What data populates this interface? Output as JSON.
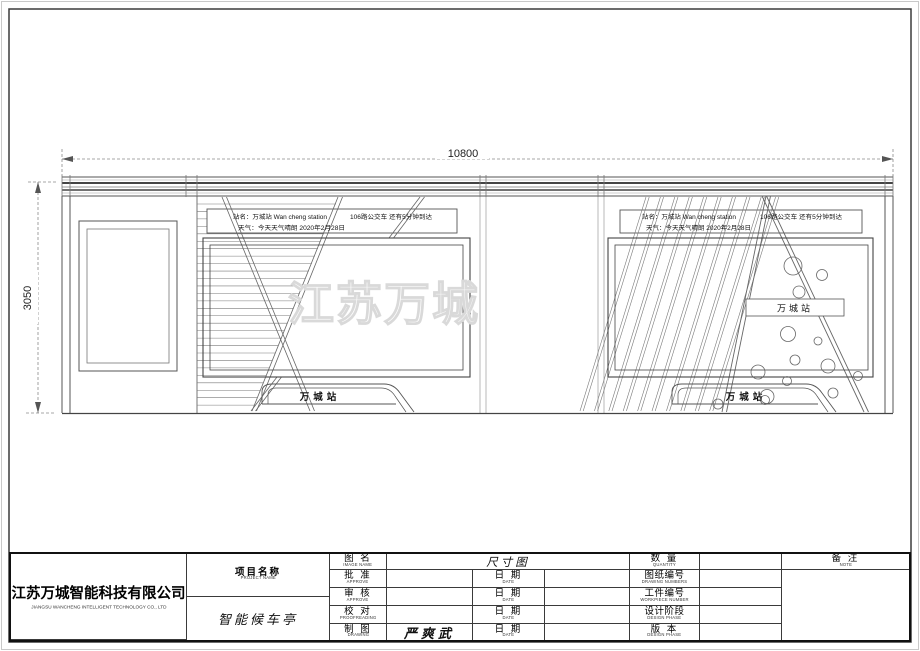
{
  "drawing": {
    "dim_width": "10800",
    "dim_height": "3050",
    "watermark": "江苏万城",
    "shelter": {
      "station_line1": "站名：万城站  Wan cheng station",
      "station_line2": "天气：今天天气晴朗  2020年2月28日",
      "bus_info": "106路公交车  还有5分钟到达",
      "station_sign": "万城站"
    }
  },
  "title_block": {
    "company": {
      "cn": "江苏万城智能科技有限公司",
      "en": "JIANGSU WANCHENG INTELLIGENT TECHNOLOGY CO., LTD"
    },
    "project": {
      "label_cn": "项目名称",
      "label_en": "PROJECT  NAME",
      "value": "智能候车亭"
    },
    "drawing_name": {
      "label_cn": "图  名",
      "label_en": "IMAGE  NAME",
      "value": "尺寸图"
    },
    "mid_rows": [
      {
        "label_cn": "批  准",
        "label_en": "APPROVE",
        "value": "",
        "date_cn": "日  期",
        "date_en": "DATE",
        "date_value": ""
      },
      {
        "label_cn": "审  核",
        "label_en": "APPROVE",
        "value": "",
        "date_cn": "日  期",
        "date_en": "DATE",
        "date_value": ""
      },
      {
        "label_cn": "校  对",
        "label_en": "PROOFREADING",
        "value": "",
        "date_cn": "日  期",
        "date_en": "DATE",
        "date_value": ""
      },
      {
        "label_cn": "制  图",
        "label_en": "DRAWING",
        "value": "严爽武",
        "date_cn": "日  期",
        "date_en": "DATE",
        "date_value": ""
      }
    ],
    "right_rows": [
      {
        "label_cn": "数  量",
        "label_en": "QUANTITY",
        "value": ""
      },
      {
        "label_cn": "图纸编号",
        "label_en": "DRAWING NUMBERS",
        "value": ""
      },
      {
        "label_cn": "工件编号",
        "label_en": "WORKPIECE NUMBER",
        "value": ""
      },
      {
        "label_cn": "设计阶段",
        "label_en": "DESIGN PHASE",
        "value": ""
      },
      {
        "label_cn": "版  本",
        "label_en": "DESIGN PHASE",
        "value": ""
      }
    ],
    "note": {
      "label_cn": "备  注",
      "label_en": "NOTE"
    }
  }
}
